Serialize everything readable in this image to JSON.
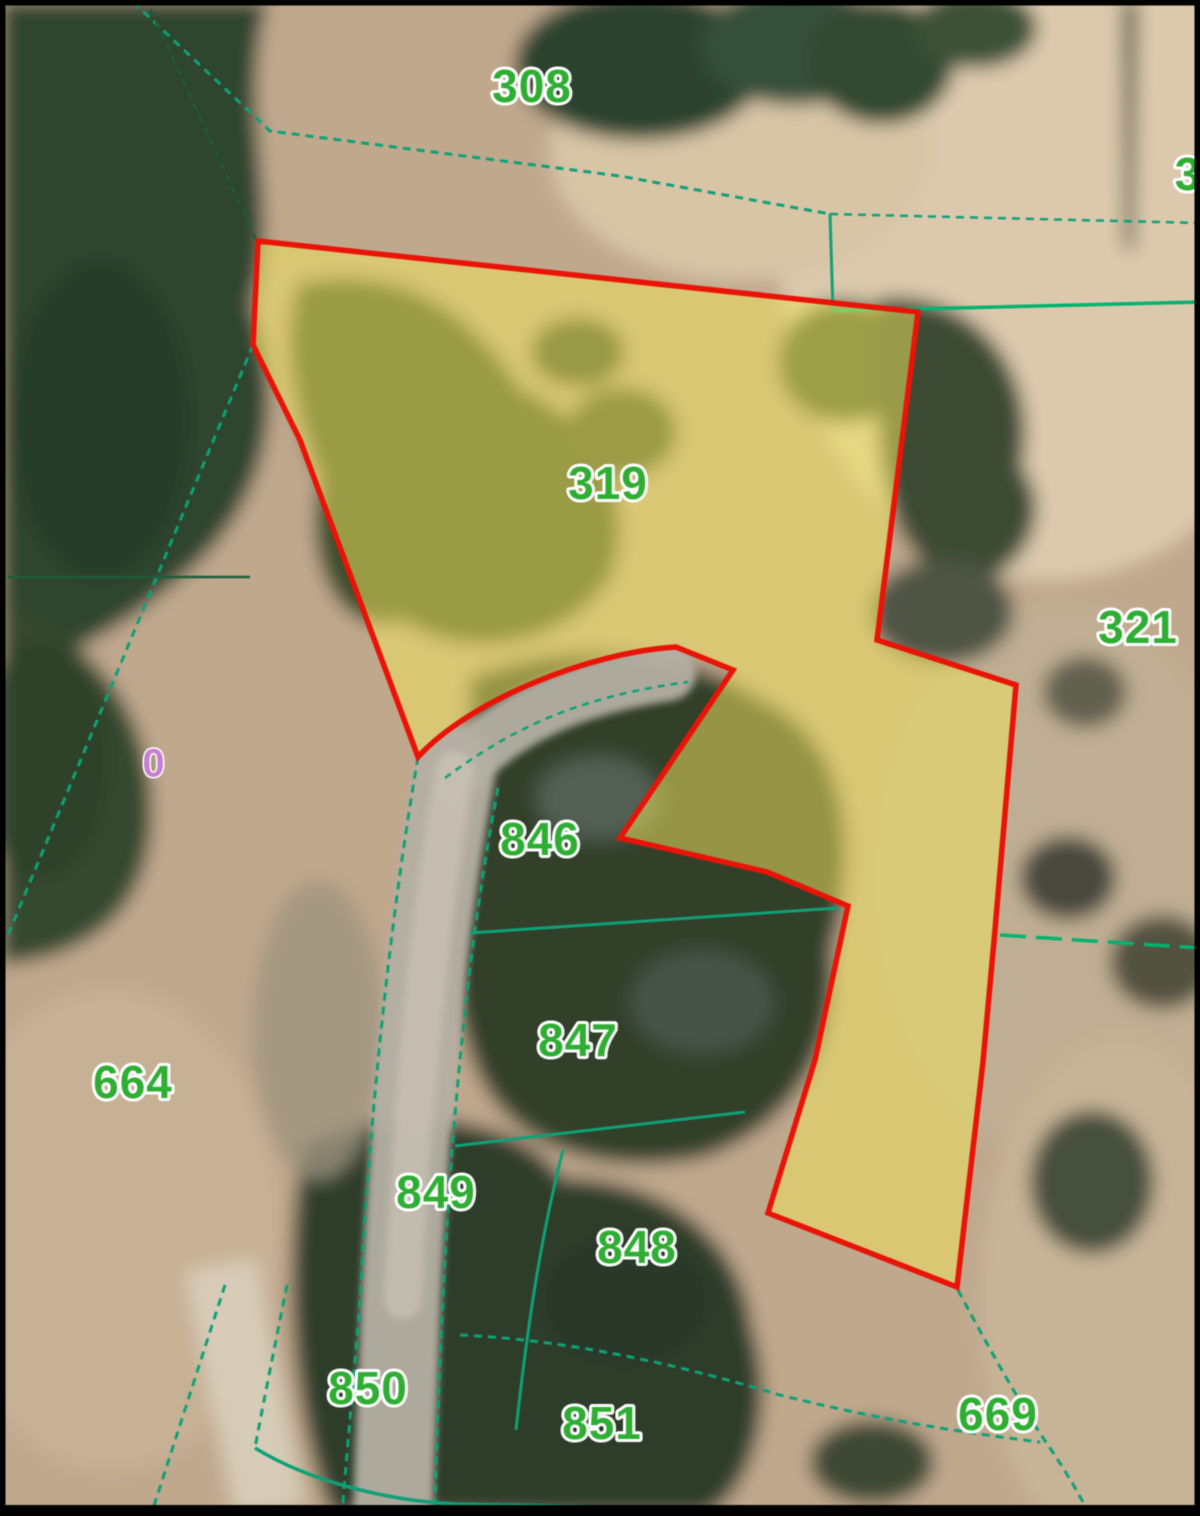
{
  "map": {
    "title": "cadastral-parcel-map",
    "base_color": "#c0a88d",
    "frame_color": "#000000",
    "colors": {
      "boundary_teal": "#0ea178",
      "boundary_bright": "#00b36e",
      "boundary_dark": "#1e5c3a",
      "parcel_outline_red": "#e91308",
      "parcel_fill_yellow": "#f0e55e",
      "label_green": "#2eae32",
      "label_halo": "#ffffff",
      "marker_purple": "#c87fd2",
      "road_grey": "#b4afa3"
    },
    "terrain_patches": [
      {
        "shape": "ellipse",
        "cx": 1050,
        "cy": 250,
        "rx": 270,
        "ry": 330,
        "fill": "#dcc9ad"
      },
      {
        "shape": "ellipse",
        "cx": 1060,
        "cy": 880,
        "rx": 190,
        "ry": 280,
        "fill": "#bfae93"
      },
      {
        "shape": "ellipse",
        "cx": 740,
        "cy": 150,
        "rx": 190,
        "ry": 130,
        "fill": "#d8c5a6"
      },
      {
        "shape": "ellipse",
        "cx": 1120,
        "cy": 1300,
        "rx": 140,
        "ry": 260,
        "fill": "#c7b497"
      },
      {
        "shape": "ellipse",
        "cx": 110,
        "cy": 1230,
        "rx": 170,
        "ry": 240,
        "fill": "#c7b195"
      },
      {
        "shape": "path",
        "d": "M0,0 L268,0 C235,120 285,205 252,305 C295,425 252,525 172,585 C112,638 42,665 0,685 Z",
        "fill": "#2e452f"
      },
      {
        "shape": "path",
        "d": "M0,600 C90,640 150,705 152,810 C152,915 85,958 0,965 Z",
        "fill": "#35492f"
      },
      {
        "shape": "ellipse",
        "cx": 100,
        "cy": 420,
        "rx": 90,
        "ry": 160,
        "fill": "#243a27",
        "opacity": 0.6
      },
      {
        "shape": "ellipse",
        "cx": 40,
        "cy": 760,
        "rx": 70,
        "ry": 120,
        "fill": "#2c402a",
        "opacity": 0.7
      },
      {
        "shape": "ellipse",
        "cx": 640,
        "cy": 65,
        "rx": 125,
        "ry": 75,
        "fill": "#2c432e"
      },
      {
        "shape": "ellipse",
        "cx": 795,
        "cy": 45,
        "rx": 95,
        "ry": 60,
        "fill": "#35503a"
      },
      {
        "shape": "ellipse",
        "cx": 882,
        "cy": 62,
        "rx": 72,
        "ry": 62,
        "fill": "#314831"
      },
      {
        "shape": "ellipse",
        "cx": 975,
        "cy": 28,
        "rx": 62,
        "ry": 40,
        "fill": "#3c5138"
      },
      {
        "shape": "path",
        "d": "M298,282 C418,258 482,328 522,388 C592,418 642,498 612,578 C562,652 462,662 402,622 C342,642 300,562 320,482 C288,402 280,330 298,282 Z",
        "fill": "#3d4d2b"
      },
      {
        "shape": "ellipse",
        "cx": 578,
        "cy": 352,
        "rx": 48,
        "ry": 36,
        "fill": "#3a4a2a"
      },
      {
        "shape": "ellipse",
        "cx": 622,
        "cy": 432,
        "rx": 56,
        "ry": 46,
        "fill": "#3f4f2c"
      },
      {
        "shape": "ellipse",
        "cx": 845,
        "cy": 362,
        "rx": 68,
        "ry": 62,
        "fill": "#43542e"
      },
      {
        "shape": "path",
        "d": "M878,298 C980,288 1042,378 1022,468 C1062,518 1012,592 952,582 C902,562 870,482 878,398 Z",
        "fill": "#3e4b36"
      },
      {
        "shape": "path",
        "d": "M468,678 C560,636 682,648 762,698 C852,740 862,850 832,948 C842,1048 792,1128 702,1158 C602,1178 502,1148 472,1058 C442,978 452,898 468,818 Z",
        "fill": "#333f2c"
      },
      {
        "shape": "ellipse",
        "cx": 598,
        "cy": 798,
        "rx": 62,
        "ry": 42,
        "fill": "#59655a",
        "opacity": 0.85
      },
      {
        "shape": "ellipse",
        "cx": 702,
        "cy": 1002,
        "rx": 72,
        "ry": 52,
        "fill": "#4a564c",
        "opacity": 0.85
      },
      {
        "shape": "path",
        "d": "M302,1148 C402,1098 522,1118 562,1178 C662,1178 742,1238 752,1328 C782,1418 742,1505 702,1516 L332,1516 C292,1418 282,1278 302,1148 Z",
        "fill": "#2f3d2b"
      },
      {
        "shape": "ellipse",
        "cx": 625,
        "cy": 1300,
        "rx": 85,
        "ry": 65,
        "fill": "#2a372a"
      },
      {
        "shape": "ellipse",
        "cx": 1068,
        "cy": 878,
        "rx": 48,
        "ry": 42,
        "fill": "#49493f"
      },
      {
        "shape": "ellipse",
        "cx": 1162,
        "cy": 962,
        "rx": 52,
        "ry": 47,
        "fill": "#52513f"
      },
      {
        "shape": "ellipse",
        "cx": 1085,
        "cy": 692,
        "rx": 42,
        "ry": 36,
        "fill": "#62604f"
      },
      {
        "shape": "ellipse",
        "cx": 942,
        "cy": 612,
        "rx": 72,
        "ry": 52,
        "fill": "#4f5444"
      },
      {
        "shape": "ellipse",
        "cx": 1092,
        "cy": 1182,
        "rx": 62,
        "ry": 72,
        "fill": "#47503d"
      },
      {
        "shape": "ellipse",
        "cx": 872,
        "cy": 1462,
        "rx": 62,
        "ry": 42,
        "fill": "#3c4835"
      },
      {
        "shape": "path",
        "d": "M1122,0 L1138,0 L1134,250 L1124,250 Z",
        "fill": "#3a3f33",
        "opacity": 0.75
      },
      {
        "shape": "path",
        "d": "M185,1272 L255,1258 L305,1505 L235,1516 Z",
        "fill": "#d9cfbd",
        "opacity": 0.9
      },
      {
        "shape": "ellipse",
        "cx": 318,
        "cy": 1030,
        "rx": 66,
        "ry": 150,
        "fill": "#9d947f",
        "opacity": 0.8
      }
    ],
    "roads": [
      {
        "d": "M456,768 C422,950 408,1150 401,1300 C397,1420 394,1470 393,1516",
        "width": 80,
        "color": "#b4afa3",
        "opacity": 0.95
      },
      {
        "d": "M452,778 C502,718 572,688 668,673",
        "width": 56,
        "color": "#b4afa3",
        "opacity": 0.95
      },
      {
        "d": "M455,770 C424,950 410,1150 403,1300",
        "width": 38,
        "color": "#ccc5b7",
        "opacity": 0.7
      }
    ],
    "boundary_lines": [
      {
        "d": "M133,2 L270,131 L620,176 L830,214",
        "color": "#0ea178",
        "width": 3,
        "dash": "8 6"
      },
      {
        "d": "M830,214 L833,311",
        "color": "#0ea178",
        "width": 3,
        "dash": ""
      },
      {
        "d": "M833,311 L1200,302",
        "color": "#00b36e",
        "width": 3.5,
        "dash": ""
      },
      {
        "d": "M830,214 L1200,223",
        "color": "#0ea178",
        "width": 2.5,
        "dash": "8 6"
      },
      {
        "d": "M253,345 L8,935",
        "color": "#0ea178",
        "width": 3,
        "dash": "8 6"
      },
      {
        "d": "M8,577 L250,577",
        "color": "#1e5c3a",
        "width": 2.5,
        "dash": ""
      },
      {
        "d": "M256,240 L150,8",
        "color": "#1e5c3a",
        "width": 2.5,
        "dash": "7 6"
      },
      {
        "d": "M418,757 C385,950 368,1150 360,1300 C352,1400 346,1460 342,1516",
        "color": "#0ea178",
        "width": 3,
        "dash": "8 6"
      },
      {
        "d": "M498,788 C465,960 450,1150 443,1300 C438,1400 436,1460 435,1516",
        "color": "#0ea178",
        "width": 3,
        "dash": "8 6"
      },
      {
        "d": "M445,778 C520,722 590,695 688,682",
        "color": "#0ea178",
        "width": 2.5,
        "dash": "7 6"
      },
      {
        "d": "M470,933 L838,908",
        "color": "#0ea178",
        "width": 3,
        "dash": ""
      },
      {
        "d": "M1000,935 L1200,948",
        "color": "#00b36e",
        "width": 3.5,
        "dash": "26 10"
      },
      {
        "d": "M455,1146 L745,1112",
        "color": "#0ea178",
        "width": 3,
        "dash": ""
      },
      {
        "d": "M563,1150 C540,1240 527,1330 516,1430",
        "color": "#0ea178",
        "width": 3,
        "dash": ""
      },
      {
        "d": "M255,1448 C310,1482 390,1501 455,1504 L705,1509",
        "color": "#0ea178",
        "width": 3.5,
        "dash": ""
      },
      {
        "d": "M225,1285 L152,1512",
        "color": "#0ea178",
        "width": 3,
        "dash": "8 6"
      },
      {
        "d": "M287,1285 C272,1360 260,1420 255,1448",
        "color": "#0ea178",
        "width": 3,
        "dash": "8 6"
      },
      {
        "d": "M958,1290 C995,1360 1030,1420 1048,1445 C1065,1470 1080,1495 1090,1516",
        "color": "#0ea178",
        "width": 3,
        "dash": "8 6"
      },
      {
        "d": "M460,1335 C570,1340 680,1365 780,1395 C860,1415 940,1430 1040,1442",
        "color": "#0ea178",
        "width": 3,
        "dash": "8 6"
      }
    ],
    "highlighted_parcel": {
      "id": "319",
      "d": "M258,241 L918,312 L877,640 L1016,685 L995,930 L983,1062 L957,1287 L768,1213 L815,1060 L848,906 L767,872 L620,838 L733,670 L676,647 C590,652 470,700 418,757 L300,440 L253,345 Z",
      "fill": "#f0e55e",
      "fill_opacity": 0.52,
      "stroke": "#e91308",
      "stroke_width": 5.5
    },
    "parcel_labels": [
      {
        "text": "308",
        "x": 532,
        "y": 90
      },
      {
        "text": "3",
        "x": 1188,
        "y": 178
      },
      {
        "text": "319",
        "x": 608,
        "y": 487
      },
      {
        "text": "321",
        "x": 1138,
        "y": 631
      },
      {
        "text": "846",
        "x": 540,
        "y": 843
      },
      {
        "text": "847",
        "x": 578,
        "y": 1044
      },
      {
        "text": "664",
        "x": 133,
        "y": 1086
      },
      {
        "text": "849",
        "x": 436,
        "y": 1196
      },
      {
        "text": "848",
        "x": 637,
        "y": 1251
      },
      {
        "text": "850",
        "x": 368,
        "y": 1392
      },
      {
        "text": "851",
        "x": 602,
        "y": 1427
      },
      {
        "text": "669",
        "x": 998,
        "y": 1418
      }
    ],
    "label_style": {
      "size": 46,
      "fill": "#2eae32",
      "halo": "#ffffff",
      "halo_width": 6
    },
    "point_marker": {
      "text": "0",
      "x": 154,
      "y": 766,
      "size": 40,
      "fill": "#c87fd2",
      "halo": "#ffffff",
      "halo_width": 3
    }
  }
}
